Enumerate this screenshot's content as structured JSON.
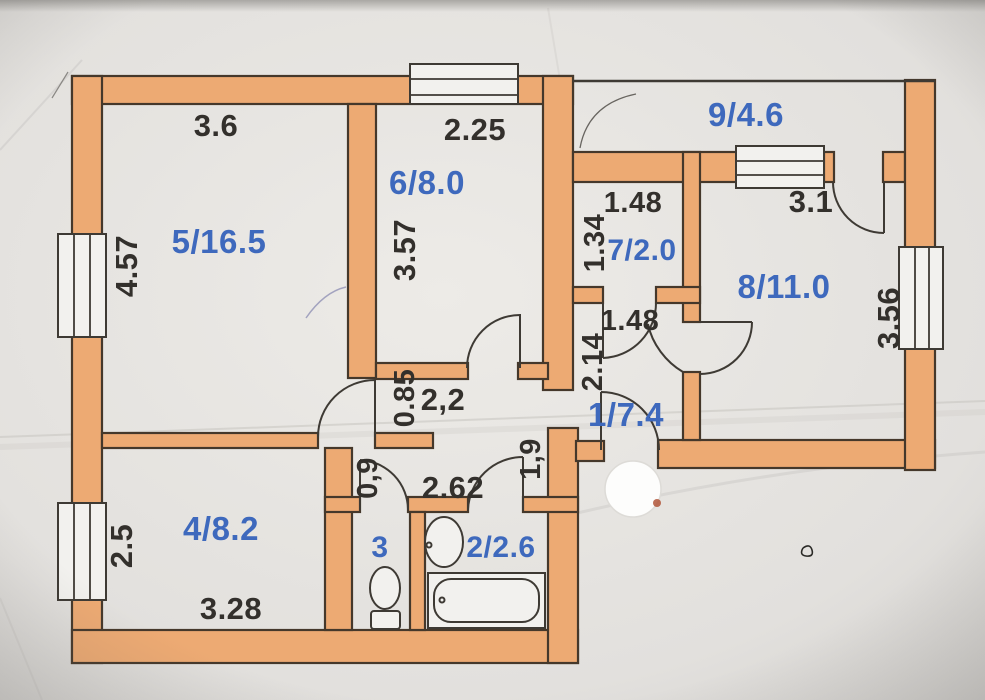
{
  "document": {
    "type": "scanned apartment floor plan",
    "paper": "photographed paper sheet"
  },
  "rooms": {
    "room5": "5/16.5",
    "room6": "6/8.0",
    "room9": "9/4.6",
    "room7": "7/2.0",
    "room8": "8/11.0",
    "hall1": "1/7.4",
    "room4": "4/8.2",
    "wc3": "3",
    "bath2": "2/2.6"
  },
  "dims": {
    "room5_top": "3.6",
    "room5_left": "4.57",
    "room6_top": "2.25",
    "room6_left": "3.57",
    "closet_top": "1.48",
    "closet_left": "1.34",
    "balcony_inner": "3.1",
    "room8_right": "3.56",
    "corridor_top": "1.48",
    "corridor_left": "2.14",
    "hall_width": "2,2",
    "hall_opening": "0.85",
    "wc_niche": "0,9",
    "bath_width": "2.62",
    "entry_width": "1,9",
    "room4_left": "2.5",
    "room4_bottom": "3.28"
  },
  "colors": {
    "wall": "#edaa73",
    "wall_outline": "#45382b",
    "line": "#3e3a34",
    "window_fill": "#f2f1ee",
    "dim_text": "#33302c",
    "room_text": "#3e69bd",
    "paper": "#e6e4e1",
    "sticker": "#fdfdfc"
  }
}
